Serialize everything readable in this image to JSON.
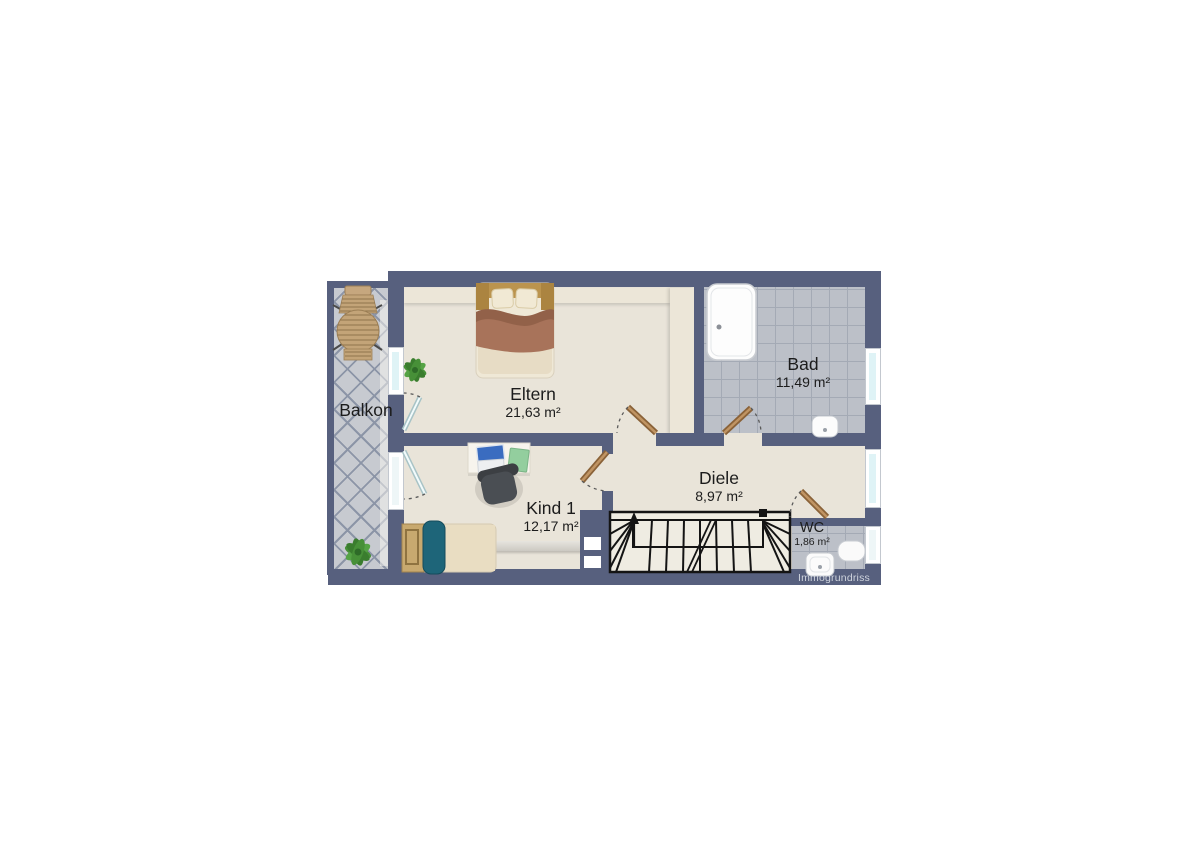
{
  "watermark": "Immogrundriss",
  "rooms": {
    "balkon": {
      "name": "Balkon"
    },
    "eltern": {
      "name": "Eltern",
      "area": "21,63 m²"
    },
    "bad": {
      "name": "Bad",
      "area": "11,49 m²"
    },
    "kind1": {
      "name": "Kind 1",
      "area": "12,17 m²"
    },
    "diele": {
      "name": "Diele",
      "area": "8,97 m²"
    },
    "wc": {
      "name": "WC",
      "area": "1,86 m²"
    }
  },
  "colors": {
    "wall": "#57607e",
    "floor": "#e9e4d9",
    "tile_bath": "#bcc0c8",
    "tile_balcony": "#c7cad0",
    "glass": "#dff3f6",
    "door_wood": "#a77e4e",
    "stair_fill": "#efece2",
    "plant_green": "#479038",
    "teal_accent": "#1e6579",
    "blanket_brown": "#a8735a",
    "label": "#1c1c1c",
    "watermark_color": "#cfd4dd"
  }
}
